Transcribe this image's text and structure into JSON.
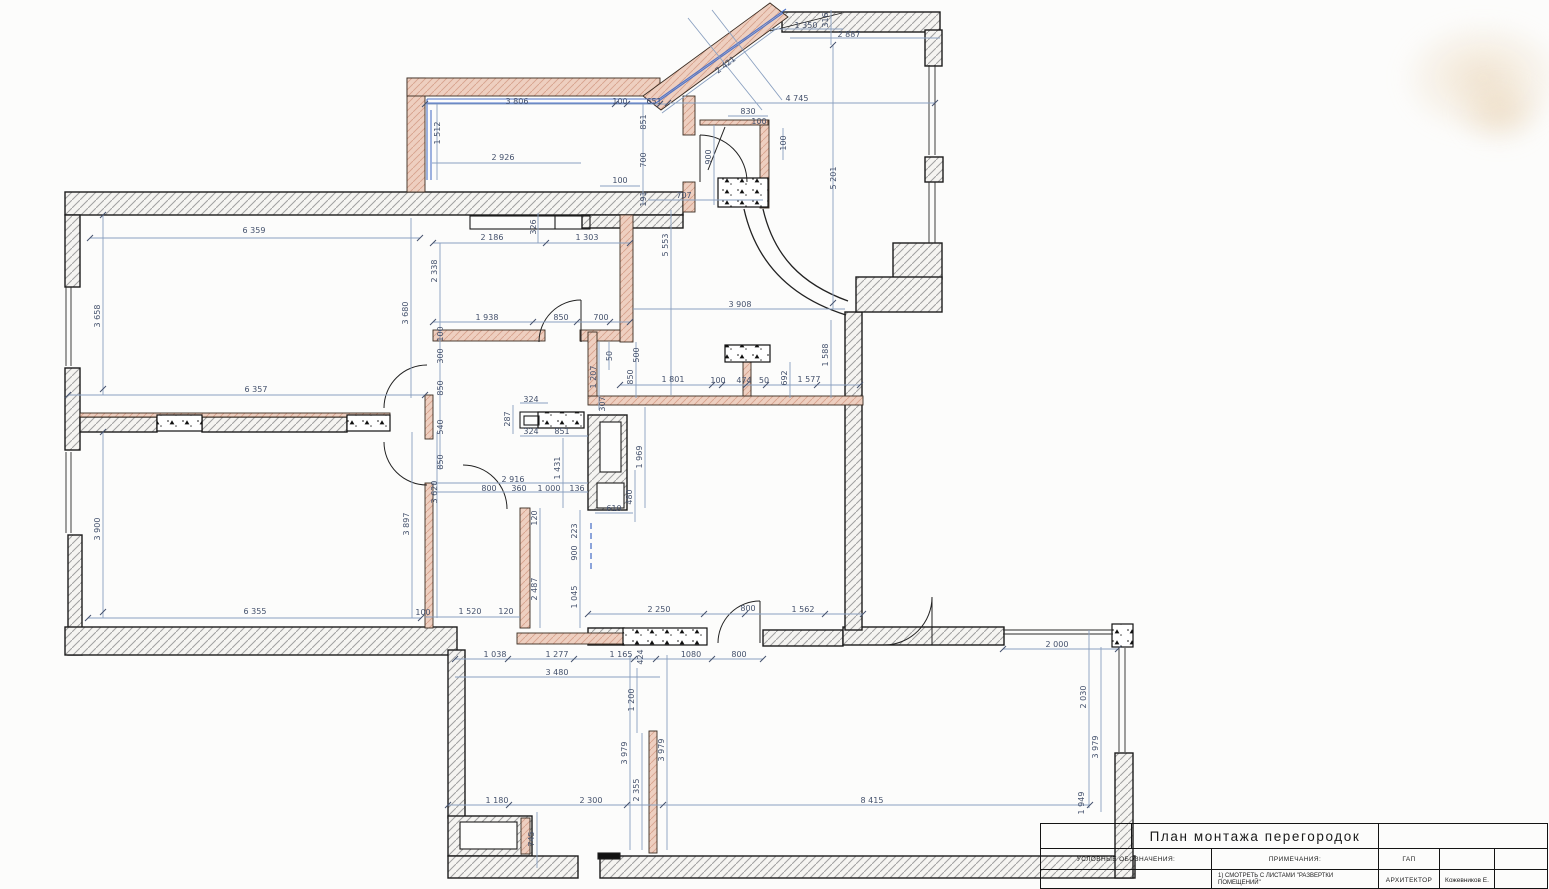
{
  "drawing": {
    "type": "architectural floor plan",
    "language": "ru"
  },
  "title_block": {
    "title": "План монтажа перегородок",
    "legend_label": "УСЛОВНЫЕ ОБОЗНАЧЕНИЯ:",
    "notes_label": "ПРИМЕЧАНИЯ:",
    "note_1": "1) СМОТРЕТЬ С ЛИСТАМИ \"РАЗВЕРТКИ ПОМЕЩЕНИЙ\"",
    "gap_label": "ГАП",
    "architect_label": "АРХИТЕКТОР",
    "architect_name": "Кожевников Е."
  },
  "colors": {
    "paper": "#fcfcfb",
    "wall_hatch": "#9e9e9e",
    "wall_outline": "#1c1c1c",
    "partition_pink": "#e9c6b5",
    "partition_hatch": "#d7a28c",
    "dimension_line": "#8aa0c0",
    "dimension_text": "#44516c",
    "glazing_blue": "#4f74c8"
  },
  "dimension_labels": [
    {
      "t": "3 806",
      "x": 517,
      "y": 104,
      "r": 0
    },
    {
      "t": "100",
      "x": 620,
      "y": 104,
      "r": 0
    },
    {
      "t": "651",
      "x": 654,
      "y": 104,
      "r": 0
    },
    {
      "t": "1 512",
      "x": 440,
      "y": 133,
      "r": -90
    },
    {
      "t": "851",
      "x": 646,
      "y": 122,
      "r": -90
    },
    {
      "t": "2 926",
      "x": 503,
      "y": 160,
      "r": 0
    },
    {
      "t": "700",
      "x": 646,
      "y": 160,
      "r": -90
    },
    {
      "t": "100",
      "x": 620,
      "y": 183,
      "r": 0
    },
    {
      "t": "191",
      "x": 646,
      "y": 199,
      "r": -90
    },
    {
      "t": "707",
      "x": 684,
      "y": 198,
      "r": 0
    },
    {
      "t": "5 553",
      "x": 668,
      "y": 245,
      "r": -90
    },
    {
      "t": "2 421",
      "x": 727,
      "y": 67,
      "r": -37
    },
    {
      "t": "1 350",
      "x": 806,
      "y": 28,
      "r": 0
    },
    {
      "t": "316",
      "x": 828,
      "y": 20,
      "r": -90
    },
    {
      "t": "2 887",
      "x": 849,
      "y": 37,
      "r": 0
    },
    {
      "t": "4 745",
      "x": 797,
      "y": 101,
      "r": 0
    },
    {
      "t": "830",
      "x": 748,
      "y": 114,
      "r": 0
    },
    {
      "t": "100",
      "x": 759,
      "y": 124,
      "r": 0
    },
    {
      "t": "100",
      "x": 786,
      "y": 143,
      "r": -90
    },
    {
      "t": "900",
      "x": 711,
      "y": 157,
      "r": -90
    },
    {
      "t": "5 201",
      "x": 836,
      "y": 178,
      "r": -90
    },
    {
      "t": "3 908",
      "x": 740,
      "y": 307,
      "r": 0
    },
    {
      "t": "1 588",
      "x": 828,
      "y": 355,
      "r": -90
    },
    {
      "t": "6 359",
      "x": 254,
      "y": 233,
      "r": 0
    },
    {
      "t": "3 658",
      "x": 100,
      "y": 316,
      "r": -90
    },
    {
      "t": "6 357",
      "x": 256,
      "y": 392,
      "r": 0
    },
    {
      "t": "2 186",
      "x": 492,
      "y": 240,
      "r": 0
    },
    {
      "t": "1 303",
      "x": 587,
      "y": 240,
      "r": 0
    },
    {
      "t": "326",
      "x": 536,
      "y": 227,
      "r": -90
    },
    {
      "t": "2 338",
      "x": 437,
      "y": 271,
      "r": -90
    },
    {
      "t": "1 938",
      "x": 487,
      "y": 320,
      "r": 0
    },
    {
      "t": "850",
      "x": 561,
      "y": 320,
      "r": 0
    },
    {
      "t": "700",
      "x": 601,
      "y": 320,
      "r": 0
    },
    {
      "t": "3 680",
      "x": 408,
      "y": 313,
      "r": -90
    },
    {
      "t": "100",
      "x": 443,
      "y": 334,
      "r": -90
    },
    {
      "t": "300",
      "x": 443,
      "y": 356,
      "r": -90
    },
    {
      "t": "850",
      "x": 443,
      "y": 388,
      "r": -90
    },
    {
      "t": "540",
      "x": 443,
      "y": 427,
      "r": -90
    },
    {
      "t": "850",
      "x": 443,
      "y": 462,
      "r": -90
    },
    {
      "t": "50",
      "x": 612,
      "y": 356,
      "r": -90
    },
    {
      "t": "500",
      "x": 639,
      "y": 355,
      "r": -90
    },
    {
      "t": "1 207",
      "x": 596,
      "y": 377,
      "r": -90
    },
    {
      "t": "850",
      "x": 633,
      "y": 377,
      "r": -90
    },
    {
      "t": "307",
      "x": 605,
      "y": 404,
      "r": -90
    },
    {
      "t": "1 801",
      "x": 673,
      "y": 382,
      "r": 0
    },
    {
      "t": "100",
      "x": 718,
      "y": 383,
      "r": 0
    },
    {
      "t": "474",
      "x": 744,
      "y": 383,
      "r": 0
    },
    {
      "t": "50",
      "x": 764,
      "y": 383,
      "r": 0
    },
    {
      "t": "692",
      "x": 787,
      "y": 378,
      "r": -90
    },
    {
      "t": "1 577",
      "x": 809,
      "y": 382,
      "r": 0
    },
    {
      "t": "324",
      "x": 531,
      "y": 402,
      "r": 0
    },
    {
      "t": "287",
      "x": 510,
      "y": 419,
      "r": -90
    },
    {
      "t": "324",
      "x": 531,
      "y": 434,
      "r": 0
    },
    {
      "t": "851",
      "x": 562,
      "y": 434,
      "r": 0
    },
    {
      "t": "1 431",
      "x": 560,
      "y": 468,
      "r": -90
    },
    {
      "t": "1 969",
      "x": 642,
      "y": 457,
      "r": -90
    },
    {
      "t": "480",
      "x": 632,
      "y": 497,
      "r": -90
    },
    {
      "t": "610",
      "x": 614,
      "y": 511,
      "r": 0
    },
    {
      "t": "2 916",
      "x": 513,
      "y": 482,
      "r": 0
    },
    {
      "t": "3 620",
      "x": 437,
      "y": 492,
      "r": -90
    },
    {
      "t": "800",
      "x": 489,
      "y": 491,
      "r": 0
    },
    {
      "t": "360",
      "x": 519,
      "y": 491,
      "r": 0
    },
    {
      "t": "1 000",
      "x": 549,
      "y": 491,
      "r": 0
    },
    {
      "t": "136",
      "x": 577,
      "y": 491,
      "r": 0
    },
    {
      "t": "120",
      "x": 537,
      "y": 518,
      "r": -90
    },
    {
      "t": "223",
      "x": 577,
      "y": 531,
      "r": -90
    },
    {
      "t": "900",
      "x": 577,
      "y": 553,
      "r": -90
    },
    {
      "t": "2 487",
      "x": 537,
      "y": 589,
      "r": -90
    },
    {
      "t": "1 045",
      "x": 577,
      "y": 597,
      "r": -90
    },
    {
      "t": "3 897",
      "x": 409,
      "y": 524,
      "r": -90
    },
    {
      "t": "3 900",
      "x": 100,
      "y": 529,
      "r": -90
    },
    {
      "t": "6 355",
      "x": 255,
      "y": 614,
      "r": 0
    },
    {
      "t": "100",
      "x": 423,
      "y": 615,
      "r": 0
    },
    {
      "t": "1 520",
      "x": 470,
      "y": 614,
      "r": 0
    },
    {
      "t": "120",
      "x": 506,
      "y": 614,
      "r": 0
    },
    {
      "t": "2 250",
      "x": 659,
      "y": 612,
      "r": 0
    },
    {
      "t": "800",
      "x": 748,
      "y": 611,
      "r": 0
    },
    {
      "t": "1 562",
      "x": 803,
      "y": 612,
      "r": 0
    },
    {
      "t": "2 000",
      "x": 1057,
      "y": 647,
      "r": 0
    },
    {
      "t": "1 038",
      "x": 495,
      "y": 657,
      "r": 0
    },
    {
      "t": "1 277",
      "x": 557,
      "y": 657,
      "r": 0
    },
    {
      "t": "1 165",
      "x": 621,
      "y": 657,
      "r": 0
    },
    {
      "t": "424",
      "x": 643,
      "y": 657,
      "r": -90
    },
    {
      "t": "1080",
      "x": 691,
      "y": 657,
      "r": 0
    },
    {
      "t": "800",
      "x": 739,
      "y": 657,
      "r": 0
    },
    {
      "t": "3 480",
      "x": 557,
      "y": 675,
      "r": 0
    },
    {
      "t": "1 200",
      "x": 634,
      "y": 700,
      "r": -90
    },
    {
      "t": "3 979",
      "x": 627,
      "y": 753,
      "r": -90
    },
    {
      "t": "3 979",
      "x": 664,
      "y": 750,
      "r": -90
    },
    {
      "t": "2 355",
      "x": 639,
      "y": 790,
      "r": -90
    },
    {
      "t": "1 180",
      "x": 497,
      "y": 803,
      "r": 0
    },
    {
      "t": "2 300",
      "x": 591,
      "y": 803,
      "r": 0
    },
    {
      "t": "745",
      "x": 534,
      "y": 839,
      "r": -90
    },
    {
      "t": "8 415",
      "x": 872,
      "y": 803,
      "r": 0
    },
    {
      "t": "2 030",
      "x": 1086,
      "y": 697,
      "r": -90
    },
    {
      "t": "3 979",
      "x": 1098,
      "y": 747,
      "r": -90
    },
    {
      "t": "1 949",
      "x": 1084,
      "y": 803,
      "r": -90
    }
  ]
}
